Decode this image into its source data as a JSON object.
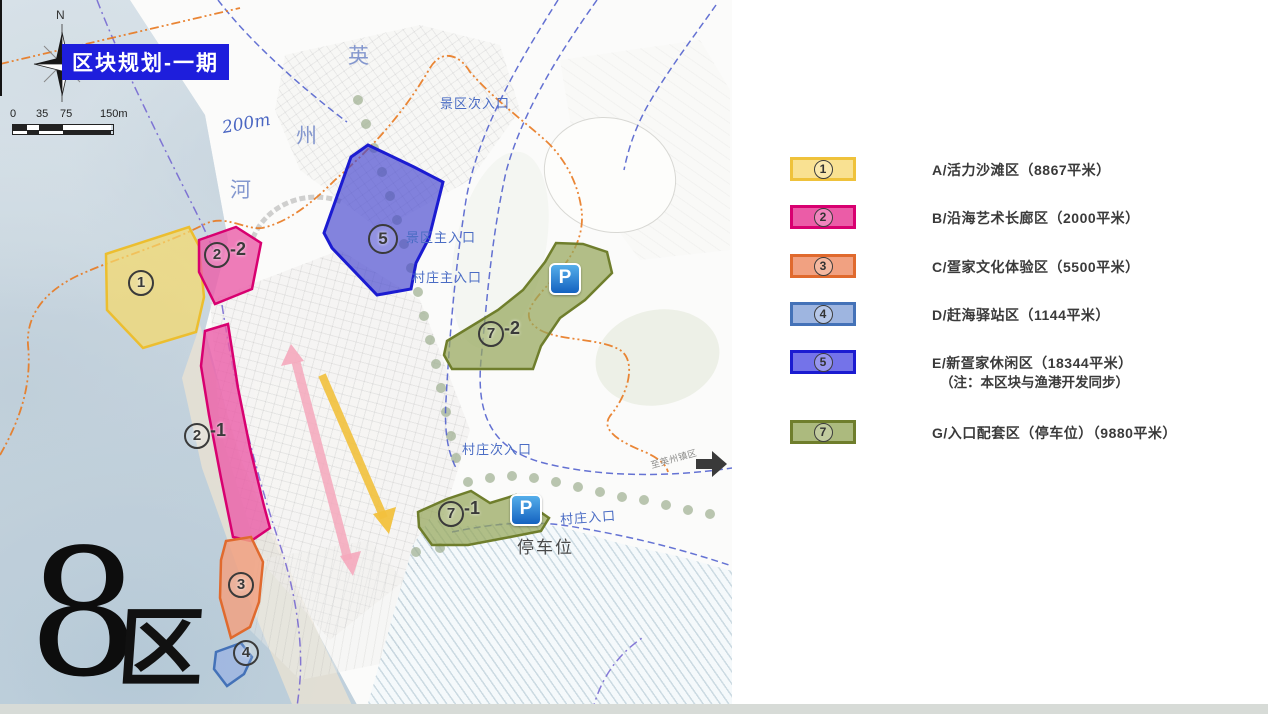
{
  "title": "区块规划-一期",
  "compass": {
    "north": "N"
  },
  "scale_bar": {
    "ticks": [
      "0",
      "35",
      "75",
      "150m"
    ]
  },
  "map_labels": {
    "river_char_1": "英",
    "river_char_2": "州",
    "river_char_3": "河",
    "depth": "200m",
    "entrance_scenic_secondary": "景区次入口",
    "entrance_scenic_main": "景区主入口",
    "entrance_village_main": "村庄主入口",
    "entrance_village_secondary": "村庄次入口",
    "entrance_village": "村庄入口",
    "to_town": "至英州镇区",
    "parking": "停车位",
    "parking_icon": "P",
    "district_number": "8",
    "district_char": "区"
  },
  "map_zones": {
    "z1": {
      "num": "1",
      "suffix": ""
    },
    "z2_2": {
      "num": "2",
      "suffix": "-2"
    },
    "z2_1": {
      "num": "2",
      "suffix": "-1"
    },
    "z3": {
      "num": "3",
      "suffix": ""
    },
    "z4": {
      "num": "4",
      "suffix": ""
    },
    "z5": {
      "num": "5",
      "suffix": ""
    },
    "z7_2": {
      "num": "7",
      "suffix": "-2"
    },
    "z7_1": {
      "num": "7",
      "suffix": "-1"
    }
  },
  "legend": {
    "rows": [
      {
        "num": "1",
        "label": "A/活力沙滩区（8867平米）",
        "note": "",
        "fill": "#f9e192",
        "border": "#efc23b"
      },
      {
        "num": "2",
        "label": "B/沿海艺术长廊区（2000平米）",
        "note": "",
        "fill": "#eb5ca7",
        "border": "#d80070"
      },
      {
        "num": "3",
        "label": "C/疍家文化体验区（5500平米）",
        "note": "",
        "fill": "#f1a181",
        "border": "#e06a2e"
      },
      {
        "num": "4",
        "label": "D/赶海驿站区（1144平米）",
        "note": "",
        "fill": "#9eb5e0",
        "border": "#4472b8"
      },
      {
        "num": "5",
        "label": "E/新疍家休闲区（18344平米）",
        "note": "（注：本区块与渔港开发同步）",
        "fill": "#7473e9",
        "border": "#1b1bd1"
      },
      {
        "num": "7",
        "label": "G/入口配套区（停车位）（9880平米）",
        "note": "",
        "fill": "#acba7e",
        "border": "#6f7e2c"
      }
    ]
  }
}
